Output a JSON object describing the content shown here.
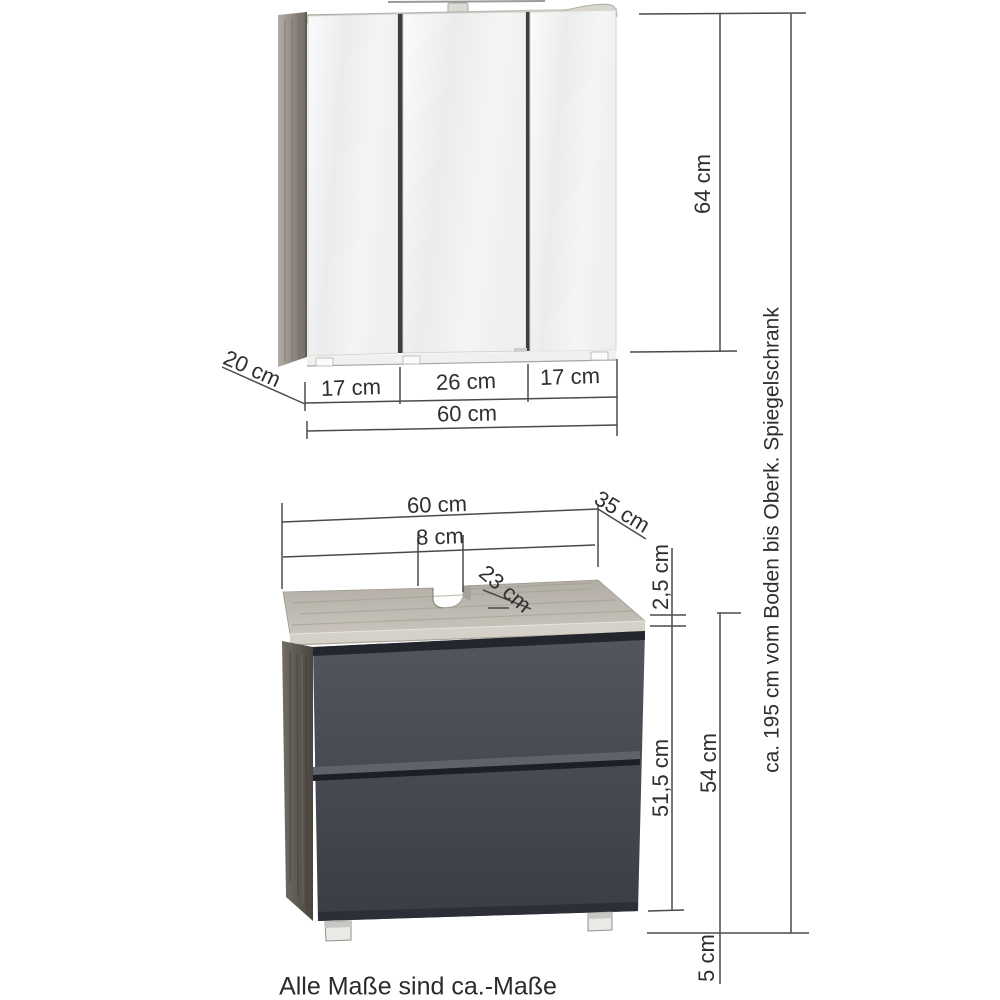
{
  "diagram": {
    "mirror_cabinet": {
      "door_widths": [
        "17 cm",
        "26 cm",
        "17 cm"
      ],
      "width": "60 cm",
      "depth": "20 cm",
      "height": "64 cm"
    },
    "overall_height": "ca. 195 cm vom Boden bis Oberk. Spiegelschrank",
    "vanity": {
      "width": "60 cm",
      "depth": "35 cm",
      "cutout_offset": "8 cm",
      "cutout_width": "23 cm",
      "top_thickness": "2,5 cm",
      "front_height": "51,5 cm",
      "body_height": "54 cm",
      "feet_height": "5 cm"
    },
    "footnote": "Alle Maße sind ca.-Maße"
  },
  "colors": {
    "dimension_line": "#4a4a4a",
    "label_text": "#2f2f2f",
    "wood_top_light": "#c3beb5",
    "wood_side": "#9b958c",
    "drawer_front": "#4a4d55",
    "mirror": "#f2f3f3"
  }
}
